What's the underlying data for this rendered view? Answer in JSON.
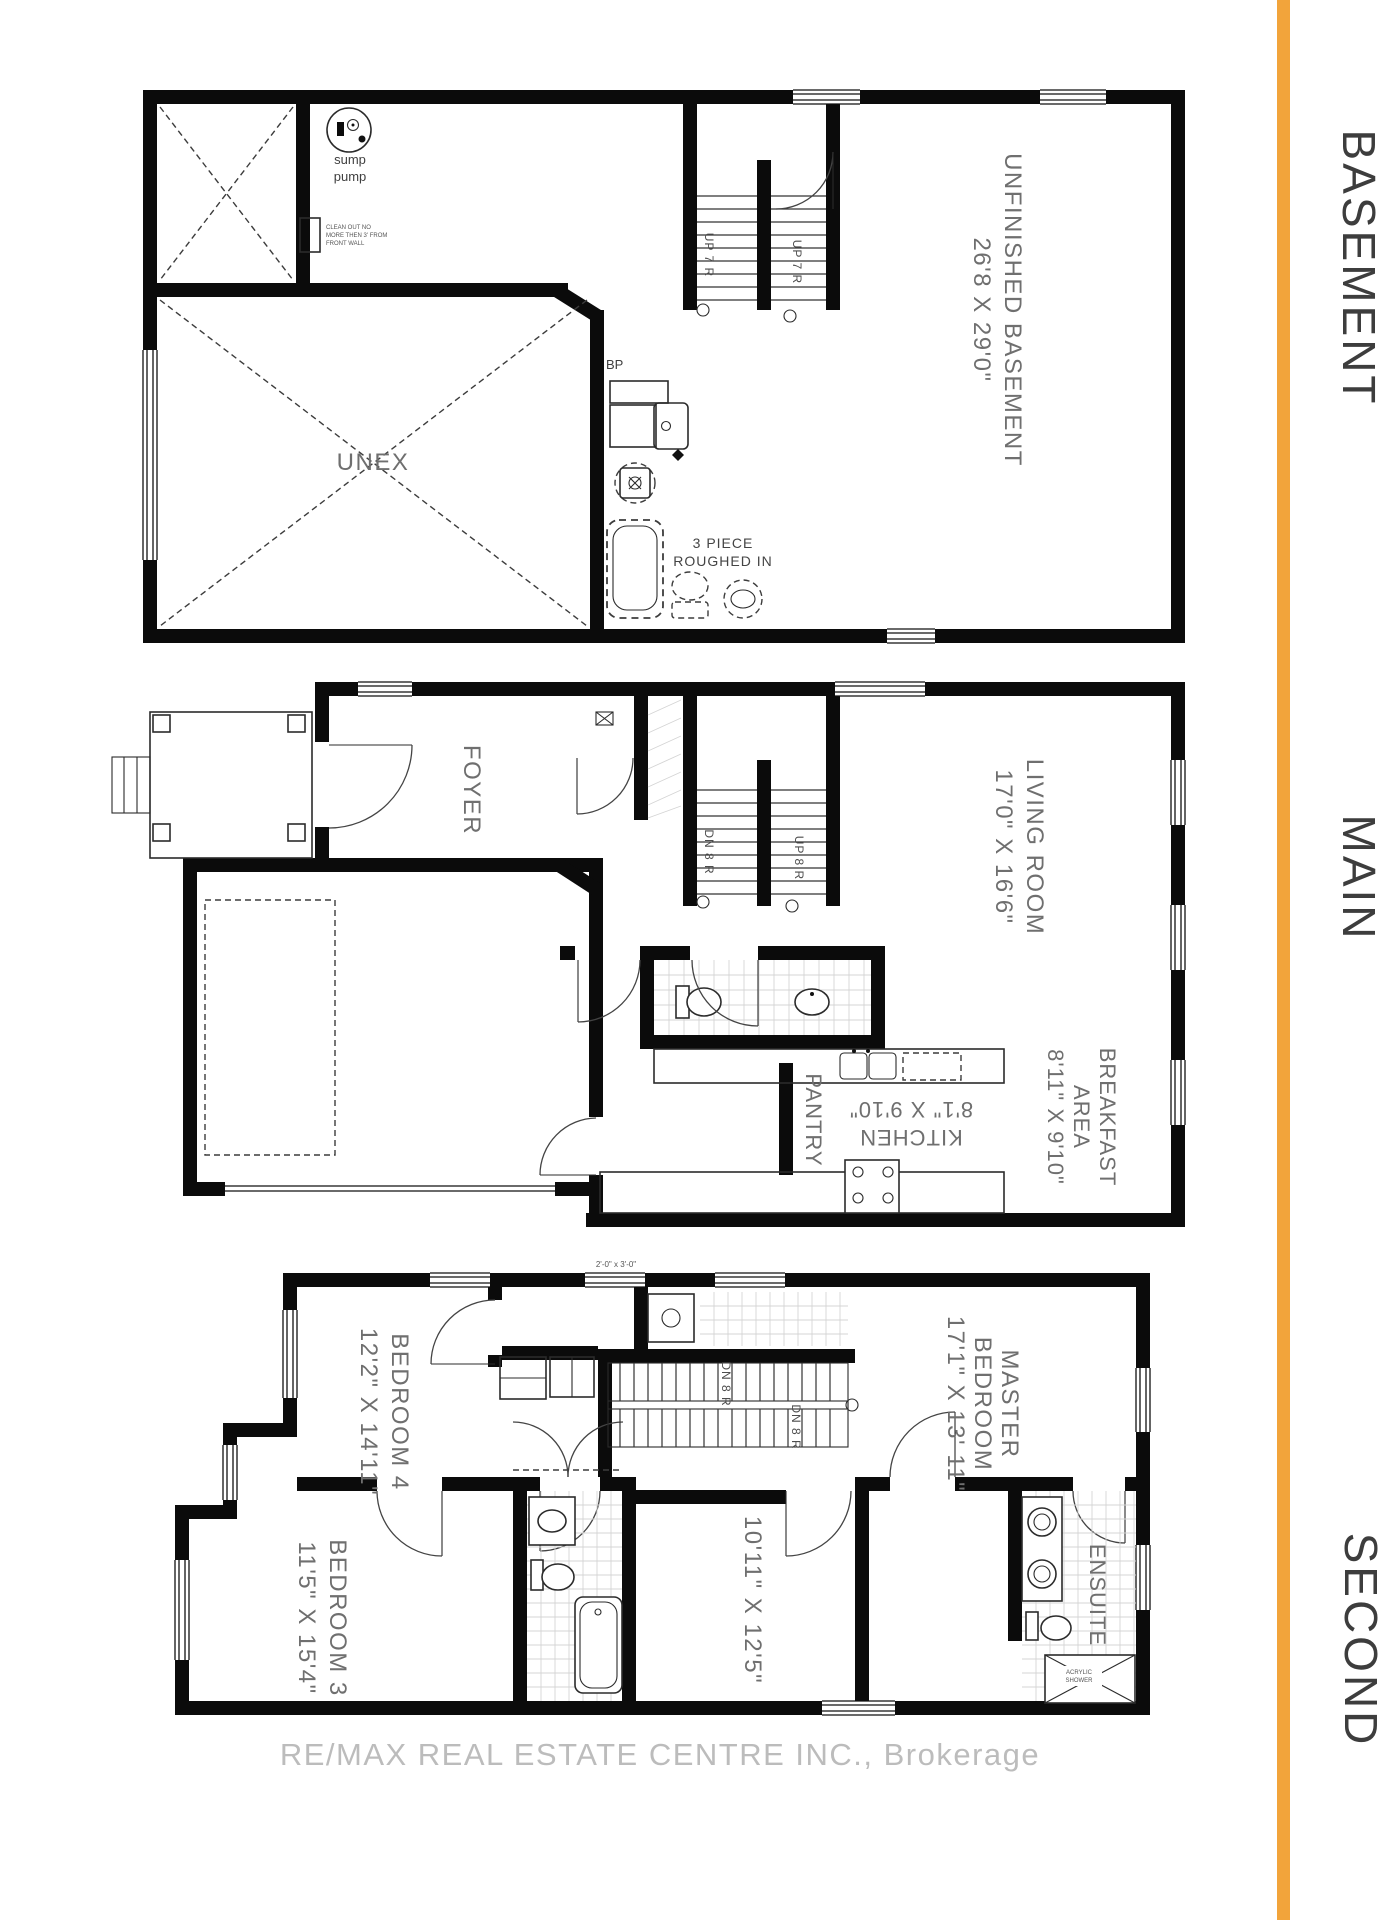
{
  "page": {
    "background": "#ffffff",
    "accent_line_color": "#F2A43B",
    "watermark_text": "RE/MAX REAL ESTATE CENTRE INC., Brokerage"
  },
  "floor_labels": {
    "basement": "BASEMENT",
    "main": "MAIN",
    "second": "SECOND"
  },
  "basement": {
    "room_name": "UNFINISHED BASEMENT",
    "room_dims": "26'8 X 29'0\"",
    "unex_label": "UNEX",
    "sump_label_line1": "sump",
    "sump_label_line2": "pump",
    "cleanout_note_line1": "CLEAN OUT NO",
    "cleanout_note_line2": "MORE THEN 3' FROM",
    "cleanout_note_line3": "FRONT WALL",
    "bp_label": "BP",
    "rough_in_line1": "3 PIECE",
    "rough_in_line2": "ROUGHED IN",
    "stairs_label_left": "UP 7 R",
    "stairs_label_right": "UP 7 R"
  },
  "main_floor": {
    "foyer_label": "FOYER",
    "living_room_name": "LIVING ROOM",
    "living_room_dims": "17'0\" X 16'6\"",
    "breakfast_line1": "BREAKFAST",
    "breakfast_line2": "AREA",
    "breakfast_dims": "8'11\" X 9'10\"",
    "kitchen_name": "KITCHEN",
    "kitchen_dims": "8'1\" X 9'10\"",
    "pantry_label": "PANTRY",
    "stairs_label_down": "DN 8 R",
    "stairs_label_up": "UP 8 R"
  },
  "second_floor": {
    "bedroom4_name": "BEDROOM 4",
    "bedroom4_dims": "12'2\" X 14'11\"",
    "bedroom3_name": "BEDROOM 3",
    "bedroom3_dims": "11'5\" X 15'4\"",
    "master_name_line1": "MASTER",
    "master_name_line2": "BEDROOM",
    "master_dims": "17'1\" X 13' 11\"",
    "bedroom2_dims": "10'11\" X 12'5\"",
    "ensuite_label": "ENSUITE",
    "shower_note_line1": "ACRYLIC",
    "shower_note_line2": "SHOWER",
    "window_dim_note": "2'-0\" x 3'-0\"",
    "stairs_label_left": "DN 8 R",
    "stairs_label_right": "DN 8 R"
  }
}
